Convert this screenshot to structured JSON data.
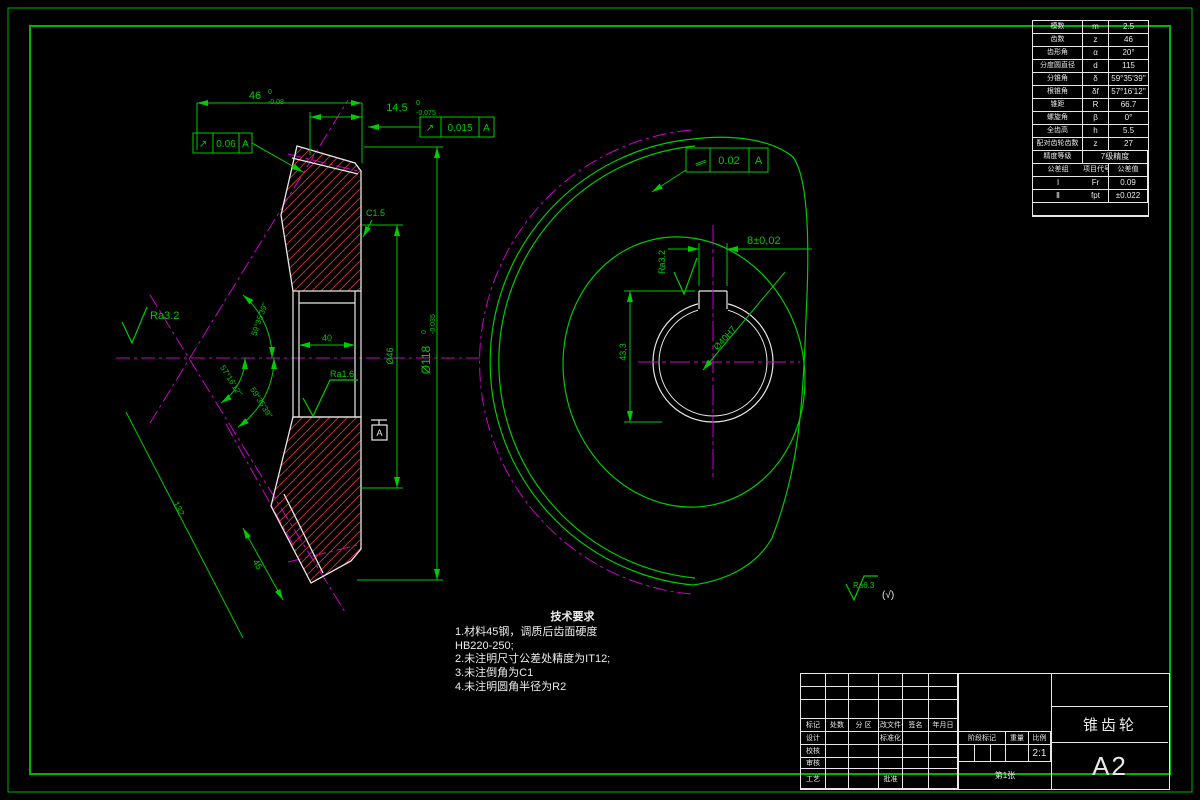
{
  "colors": {
    "background": "#000000",
    "frame_green": "#00b400",
    "dimension_green": "#00cc00",
    "object_white": "#e8e8e8",
    "hatch_red": "#c03030",
    "centerline_magenta": "#cc00cc"
  },
  "ptable": {
    "rows": [
      {
        "n": "模数",
        "s": "m",
        "v": "2.5"
      },
      {
        "n": "齿数",
        "s": "z",
        "v": "46"
      },
      {
        "n": "齿形角",
        "s": "α",
        "v": "20°"
      },
      {
        "n": "分度圆直径",
        "s": "d",
        "v": "115"
      },
      {
        "n": "分锥角",
        "s": "δ",
        "v": "59°35'39''"
      },
      {
        "n": "根锥角",
        "s": "δf",
        "v": "57°16'12''"
      },
      {
        "n": "锥距",
        "s": "R",
        "v": "66.7"
      },
      {
        "n": "螺旋角",
        "s": "β",
        "v": "0°"
      },
      {
        "n": "全齿高",
        "s": "h",
        "v": "5.5"
      },
      {
        "n": "配对齿轮齿数",
        "s": "z",
        "v": "27"
      }
    ],
    "precision_label": "精度等级",
    "precision_value": "7级精度",
    "tol_headers": [
      "公差组",
      "项目代号",
      "公差值"
    ],
    "tol_rows": [
      {
        "g": "Ⅰ",
        "c": "Fr",
        "v": "0.09"
      },
      {
        "g": "Ⅱ",
        "c": "fpt",
        "v": "±0.022"
      }
    ]
  },
  "tb": {
    "header_cells": [
      "标记",
      "处数",
      "分 区",
      "更改文件号",
      "签名",
      "年月日"
    ],
    "row_design": "设计",
    "row_check": "校核",
    "row_review": "审核",
    "row_process": "工艺",
    "standardization": "标准化",
    "approve": "批准",
    "stage_label": "阶段标记",
    "weight_label": "重量",
    "scale_label": "比例",
    "scale_value": "2:1",
    "sheet_info": "第1张",
    "part_name": "锥齿轮",
    "sheet_size": "A2"
  },
  "tech": {
    "title": "技术要求",
    "lines": [
      "1.材料45钢，调质后齿面硬度",
      "HB220-250;",
      "2.未注明尺寸公差处精度为IT12;",
      "3.未注倒角为C1",
      "4.未注明圆角半径为R2"
    ]
  },
  "dims": {
    "d46": {
      "main": "46",
      "sup": "0",
      "sub": "-0,08"
    },
    "d145": {
      "main": "14,5",
      "sup": "0",
      "sub": "-0,075"
    },
    "d118": {
      "main": "Ø118",
      "sup": "0",
      "sub": "-0,035"
    },
    "d46b": "Ø46",
    "chamfer": "C1.5",
    "bore_width": "40",
    "ra32_left": "Ra3.2",
    "ra16": "Ra1.6",
    "angle_top": "59°35'39''",
    "angle_inner": "57°16'12''",
    "angle_outer": "59°35'39''",
    "len132": "132",
    "len45": "45",
    "datum": "A",
    "gdt1": {
      "sym": "↗",
      "val": "0.06",
      "datum": "A"
    },
    "gdt2": {
      "sym": "↗",
      "val": "0.015",
      "datum": "A"
    },
    "gdt3": {
      "sym": "∥",
      "val": "0.02",
      "datum": "A"
    },
    "key_width": "8±0,02",
    "key_depth": "43,3",
    "bore_dia": "Ø40H7",
    "ra32_right": "Ra3.2",
    "other_rough": "Ra6.3",
    "other_rough_suffix": "(√)"
  }
}
